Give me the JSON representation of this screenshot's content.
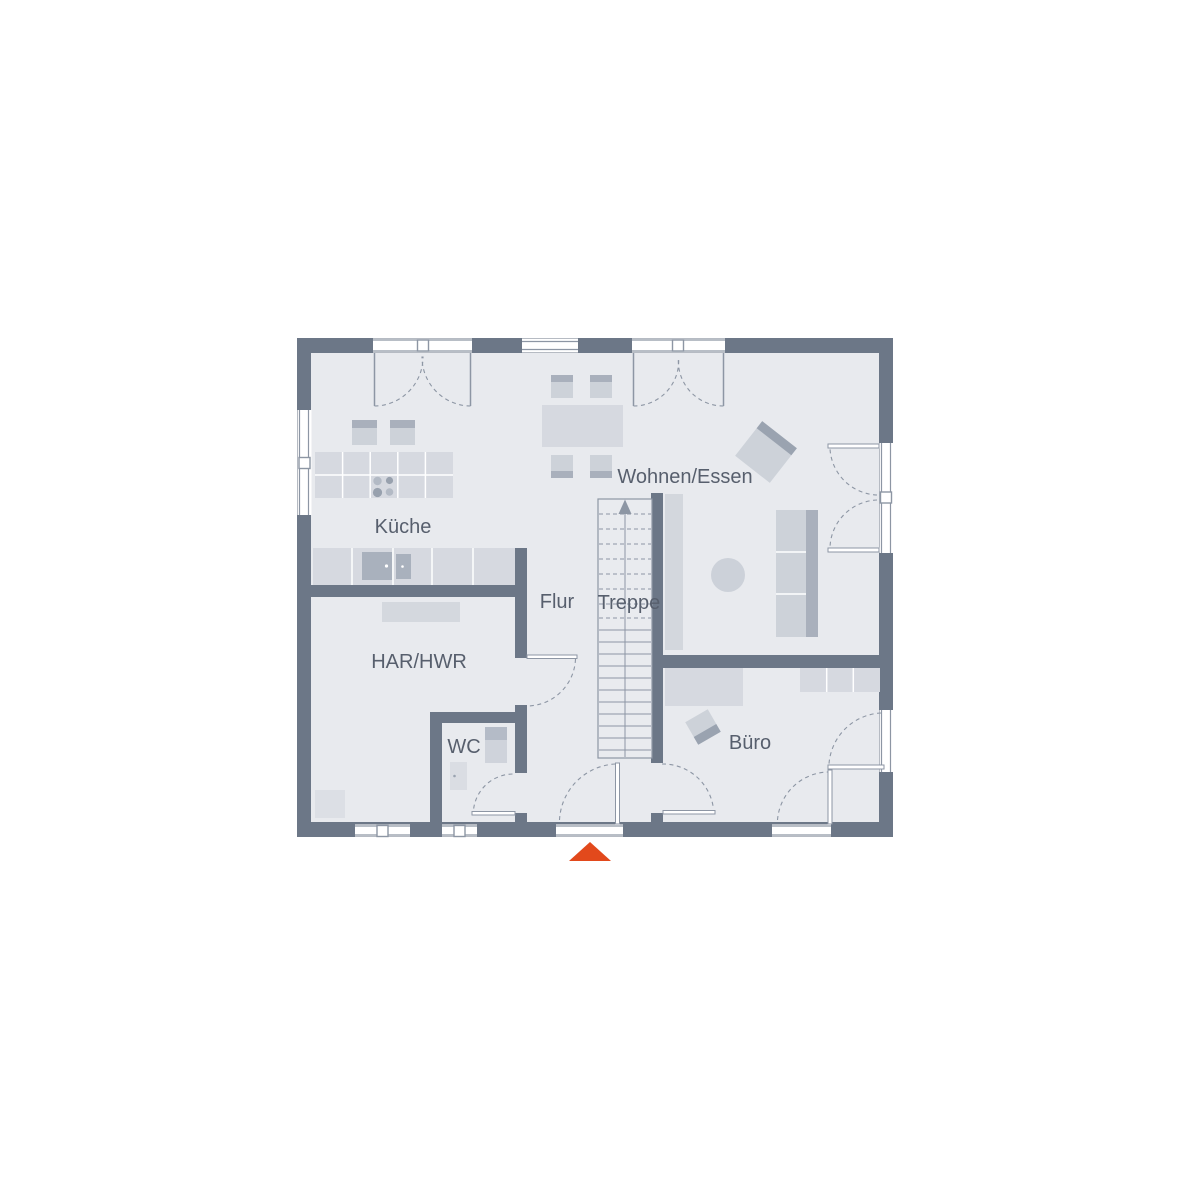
{
  "plan": {
    "type": "residential-floor-plan",
    "rooms": [
      {
        "label": "Küche"
      },
      {
        "label": "Wohnen/Essen"
      },
      {
        "label": "Flur"
      },
      {
        "label": "Treppe"
      },
      {
        "label": "HAR/HWR"
      },
      {
        "label": "WC"
      },
      {
        "label": "Büro"
      }
    ],
    "stairs": {
      "direction": "up"
    },
    "entrance_marker": {
      "shape": "triangle",
      "color": "#e2491c"
    },
    "colors": {
      "background": "#ffffff",
      "wall": "#6c7787",
      "floor": "#e8eaee",
      "furniture_light": "#d6d9e0",
      "furniture_mid": "#cdd2d9",
      "furniture_dark": "#a9b0bc",
      "line": "#8d96a4",
      "label": "#575f6d",
      "accent": "#e2491c"
    }
  }
}
